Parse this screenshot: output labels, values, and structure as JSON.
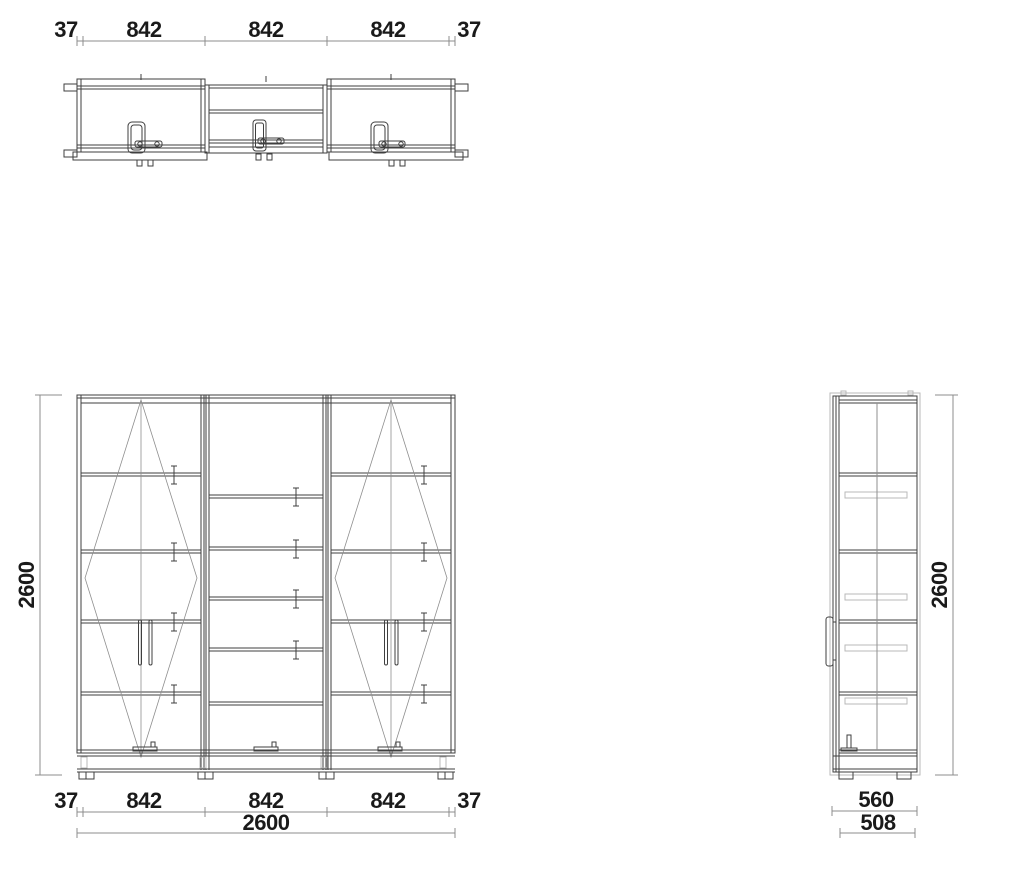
{
  "colors": {
    "background": "#ffffff",
    "line": "#3f3f3f",
    "line-medium": "#8f8f8f",
    "line-light": "#b9b9b9",
    "dim-line": "#8c8c8c",
    "dim-text": "#1a1a1a"
  },
  "dims": {
    "plan_top": [
      "37",
      "842",
      "842",
      "842",
      "37"
    ],
    "front_bottom": [
      "37",
      "842",
      "842",
      "842",
      "37"
    ],
    "front_total_width": "2600",
    "front_height": "2600",
    "side_height": "2600",
    "side_depth_outer": "560",
    "side_depth_inner": "508"
  }
}
